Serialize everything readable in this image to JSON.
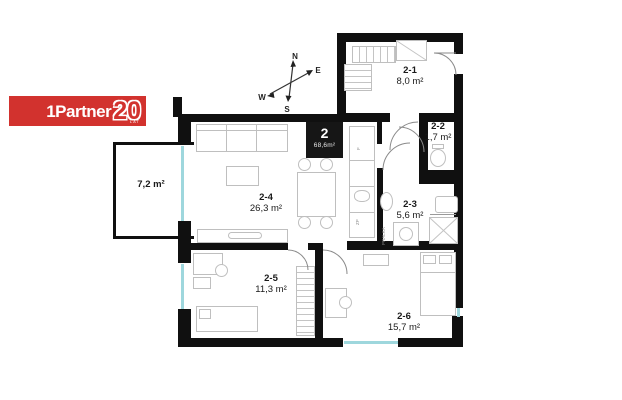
{
  "logo": {
    "prefix": "1",
    "brand": "Partner",
    "badge": "20",
    "tagline": "LAT",
    "background": "#d2322e",
    "foreground": "#ffffff"
  },
  "unit_badge": {
    "number": "2",
    "area": "68,6m²"
  },
  "compass": {
    "north": "N",
    "east": "E",
    "south": "S",
    "west": "W"
  },
  "rooms": [
    {
      "id": "2-1",
      "area": "8,0 m²"
    },
    {
      "id": "2-2",
      "area": "1,7 m²"
    },
    {
      "id": "2-3",
      "area": "5,6 m²"
    },
    {
      "id": "2-4",
      "area": "26,3 m²"
    },
    {
      "id": "2-5",
      "area": "11,3 m²"
    },
    {
      "id": "2-6",
      "area": "15,7 m²"
    }
  ],
  "balcony": {
    "area": "7,2 m²"
  },
  "annotations": {
    "washer": "PRALKA",
    "kitchen_unit_1": "F",
    "kitchen_unit_2": "ZP"
  },
  "colors": {
    "wall": "#101010",
    "window": "#9ed7dd",
    "furniture_line": "#bfbfbf",
    "logo_red": "#d2322e"
  }
}
